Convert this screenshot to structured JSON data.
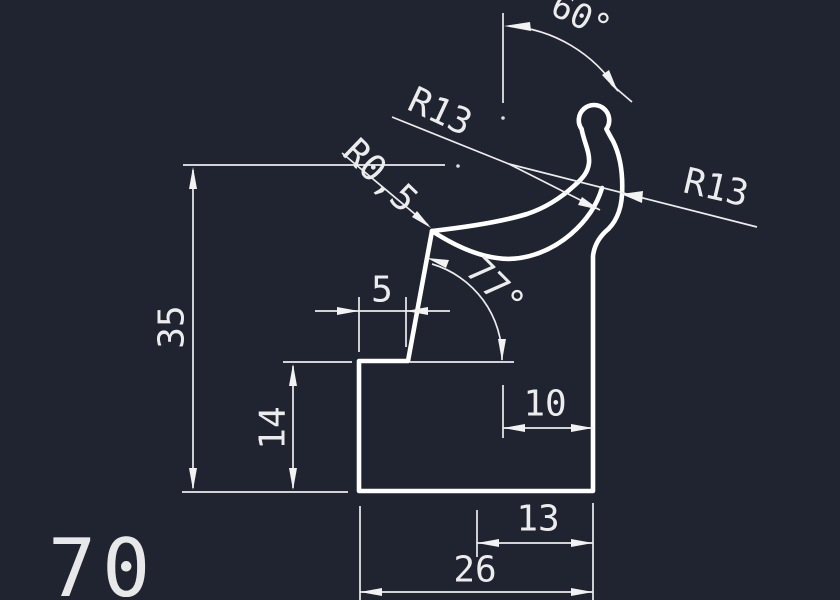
{
  "canvas": {
    "background": "#1f2430",
    "geometry_color": "#ffffff",
    "dimension_color": "#ececec"
  },
  "labels": {
    "angle_60": "60°",
    "r13_upper": "R13",
    "r13_right": "R13",
    "r05": "R0,5",
    "h35": "35",
    "w5": "5",
    "angle_77": "77°",
    "h14": "14",
    "w10": "10",
    "w13": "13",
    "w26": "26",
    "sheet_number": "70"
  }
}
